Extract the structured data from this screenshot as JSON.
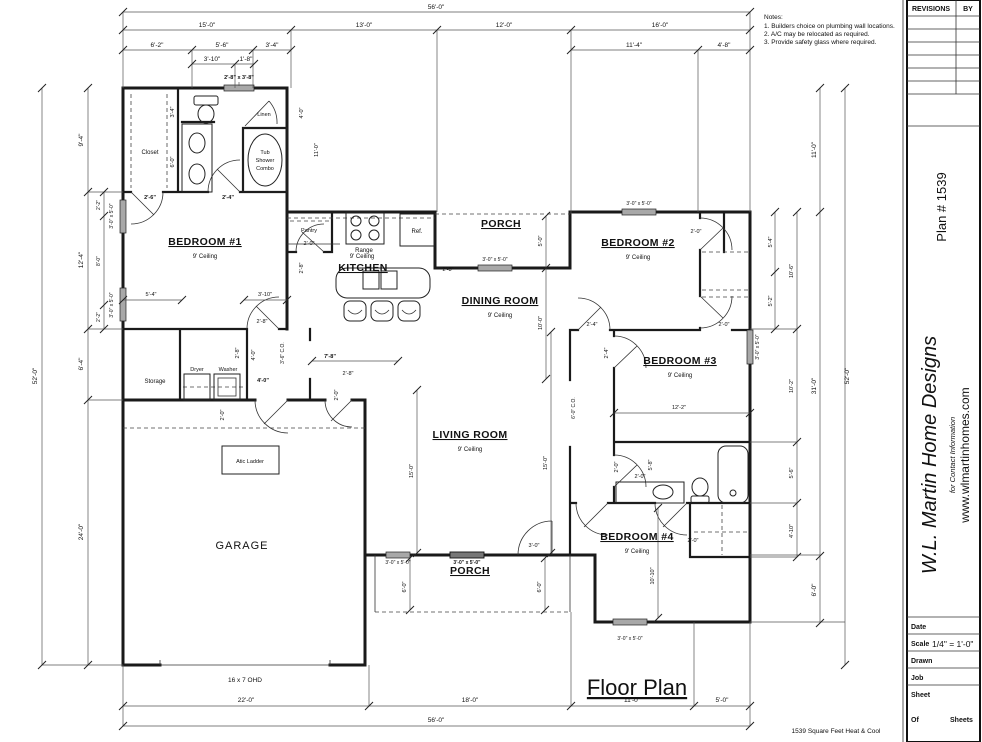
{
  "notes": {
    "title": "Notes:",
    "items": [
      "1.  Builders choice on plumbing wall locations.",
      "2.  A/C may be relocated as required.",
      "3.  Provide safety glass where required."
    ]
  },
  "title_block": {
    "revisions": "REVISIONS",
    "by": "BY",
    "plan_number": "Plan # 1539",
    "company": "W.L. Martin Home Designs",
    "tagline": "for Contact Information",
    "website": "www.wlmartinhomes.com",
    "date_label": "Date",
    "scale_label": "Scale",
    "scale_value": "1/4\" = 1'-0\"",
    "drawn_label": "Drawn",
    "job_label": "Job",
    "sheet_label": "Sheet",
    "of_label": "Of",
    "sheets_label": "Sheets"
  },
  "plan": {
    "title": "Floor Plan",
    "area_note": "1539 Square Feet Heat & Cool",
    "porch": "PORCH",
    "garage": "GARAGE",
    "storage": "Storage",
    "rooms": [
      {
        "name": "BEDROOM #1",
        "ceiling": "9' Ceiling"
      },
      {
        "name": "KITCHEN",
        "ceiling": "9' Ceiling"
      },
      {
        "name": "DINING ROOM",
        "ceiling": "9' Ceiling"
      },
      {
        "name": "LIVING ROOM",
        "ceiling": "9' Ceiling"
      },
      {
        "name": "BEDROOM #2",
        "ceiling": "9' Ceiling"
      },
      {
        "name": "BEDROOM #3",
        "ceiling": "9' Ceiling"
      },
      {
        "name": "BEDROOM #4",
        "ceiling": "9' Ceiling"
      }
    ],
    "fixtures": {
      "closet": "Closet",
      "linen": "Linen",
      "tub": [
        "Tub",
        "Shower",
        "Combo"
      ],
      "pantry": "Pantry",
      "range": "Range",
      "ref": "Ref.",
      "dryer": "Dryer",
      "washer": "Washer",
      "attic": "Atic Ladder",
      "ohd": "16 x 7 OHD"
    },
    "dims": {
      "top_total": "56'-0\"",
      "top_seg": [
        "15'-0\"",
        "13'-0\"",
        "12'-0\"",
        "16'-0\""
      ],
      "top_sub": [
        "6'-2\"",
        "5'-6\"",
        "3'-4\"",
        "11'-4\"",
        "4'-8\""
      ],
      "top_sub2": [
        "3'-10\"",
        "1'-8\""
      ],
      "top_window": "2'-8\" x 3'-8\"",
      "win35": "3'-0\" x 5'-0\"",
      "left_total": "52'-0\"",
      "left_seg": [
        "9'-4\"",
        "12'-4\"",
        "6'-4\"",
        "24'-0\""
      ],
      "left_sub": [
        "2'-2\"",
        "8'-0\"",
        "2'-2\""
      ],
      "right_total": "52'-0\"",
      "right_seg": [
        "11'-0\"",
        "31'-0\"",
        "6'-0\""
      ],
      "right_sub": [
        "10'-6\"",
        "10'-2\"",
        "5'-6\"",
        "4'-10\""
      ],
      "right_sub2": [
        "5'-4\"",
        "5'-2\""
      ],
      "bottom_seg": [
        "22'-0\"",
        "18'-0\"",
        "11'-0\"",
        "5'-0\""
      ],
      "bottom_total": "56'-0\""
    },
    "interior": [
      "2'-6\"",
      "2'-4\"",
      "3'-4\"",
      "6'-0\"",
      "5'-4\"",
      "3'-10\"",
      "2'-8\"",
      "2'-0\"",
      "2'-8\"",
      "2'-8\"",
      "4'-0\"",
      "3'-6\" C.O.",
      "7'-8\"",
      "4'-0\"",
      "2'-0\"",
      "2'-8\"",
      "2'-0\"",
      "5'-0\"",
      "10'-0\"",
      "15'-0\"",
      "15'-0\"",
      "6'-0\" C.O.",
      "2'-4\"",
      "2'-0\"",
      "2'-0\"",
      "2'-4\"",
      "12'-2\"",
      "2'-0\"",
      "2'-0\"",
      "5'-8\"",
      "2'-0\"",
      "10'-10\"",
      "3'-0\"",
      "6'-0\"",
      "6'-0\"",
      "4'-0\"",
      "11'-0\"",
      "2'-8\""
    ]
  }
}
